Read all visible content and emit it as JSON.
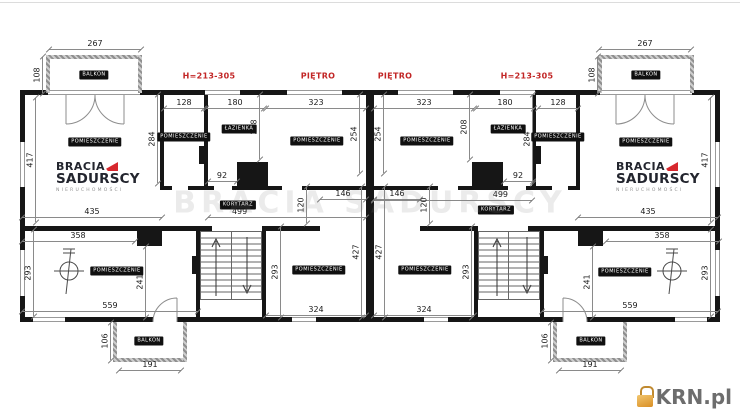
{
  "watermark": {
    "text": "BRACIA SADURSCY"
  },
  "logo": {
    "line1": "BRACIA",
    "line2": "SADURSCY",
    "line3": "NIERUCHOMOŚCI"
  },
  "krn": {
    "label": "KRN.pl"
  },
  "red_labels": [
    {
      "text": "H=213-305",
      "x": 209,
      "y": 76
    },
    {
      "text": "PIĘTRO",
      "x": 318,
      "y": 76
    },
    {
      "text": "PIĘTRO",
      "x": 395,
      "y": 76
    },
    {
      "text": "H=213-305",
      "x": 527,
      "y": 76
    }
  ],
  "room_badges": [
    {
      "text": "POMIESZCZENIE",
      "x": 95,
      "y": 142
    },
    {
      "text": "POMIESZCZENIE",
      "x": 184,
      "y": 137
    },
    {
      "text": "ŁAZIENKA",
      "x": 239,
      "y": 129
    },
    {
      "text": "POMIESZCZENIE",
      "x": 317,
      "y": 141
    },
    {
      "text": "KORYTARZ",
      "x": 238,
      "y": 205
    },
    {
      "text": "POMIESZCZENIE",
      "x": 117,
      "y": 271
    },
    {
      "text": "POMIESZCZENIE",
      "x": 319,
      "y": 270
    },
    {
      "text": "BALKON",
      "x": 94,
      "y": 75
    },
    {
      "text": "BALKON",
      "x": 149,
      "y": 341
    },
    {
      "text": "POMIESZCZENIE",
      "x": 646,
      "y": 142
    },
    {
      "text": "POMIESZCZENIE",
      "x": 558,
      "y": 137
    },
    {
      "text": "ŁAZIENKA",
      "x": 508,
      "y": 129
    },
    {
      "text": "POMIESZCZENIE",
      "x": 427,
      "y": 141
    },
    {
      "text": "KORYTARZ",
      "x": 496,
      "y": 210
    },
    {
      "text": "POMIESZCZENIE",
      "x": 625,
      "y": 272
    },
    {
      "text": "POMIESZCZENIE",
      "x": 425,
      "y": 270
    },
    {
      "text": "BALKON",
      "x": 646,
      "y": 75
    },
    {
      "text": "BALKON",
      "x": 591,
      "y": 341
    }
  ],
  "dims": [
    {
      "t": "267",
      "x": 95,
      "y": 49,
      "len": 92
    },
    {
      "t": "108",
      "x": 42,
      "y": 75,
      "len": 36,
      "v": true
    },
    {
      "t": "128",
      "x": 184,
      "y": 108,
      "len": 40
    },
    {
      "t": "180",
      "x": 235,
      "y": 108,
      "len": 58
    },
    {
      "t": "323",
      "x": 316,
      "y": 108,
      "len": 100
    },
    {
      "t": "284",
      "x": 157,
      "y": 139,
      "len": 88,
      "v": true
    },
    {
      "t": "208",
      "x": 259,
      "y": 127,
      "len": 64,
      "v": true
    },
    {
      "t": "254",
      "x": 359,
      "y": 134,
      "len": 78,
      "v": true
    },
    {
      "t": "92",
      "x": 222,
      "y": 181,
      "len": 29
    },
    {
      "t": "417",
      "x": 35,
      "y": 160,
      "len": 124,
      "v": true
    },
    {
      "t": "435",
      "x": 92,
      "y": 217,
      "len": 140
    },
    {
      "t": "499",
      "x": 287,
      "y": 217,
      "len": 158,
      "lx": 20
    },
    {
      "t": "146",
      "x": 343,
      "y": 199,
      "len": 46
    },
    {
      "t": "120",
      "x": 306,
      "y": 205,
      "len": 36,
      "v": true
    },
    {
      "t": "293",
      "x": 280,
      "y": 272,
      "len": 90,
      "v": true
    },
    {
      "t": "324",
      "x": 316,
      "y": 315,
      "len": 100
    },
    {
      "t": "427",
      "x": 361,
      "y": 252,
      "len": 130,
      "v": true
    },
    {
      "t": "358",
      "x": 78,
      "y": 241,
      "len": 113
    },
    {
      "t": "293",
      "x": 33,
      "y": 273,
      "len": 86,
      "v": true
    },
    {
      "t": "241",
      "x": 145,
      "y": 282,
      "len": 70,
      "v": true
    },
    {
      "t": "559",
      "x": 110,
      "y": 311,
      "len": 176
    },
    {
      "t": "106",
      "x": 110,
      "y": 341,
      "len": 37,
      "v": true
    },
    {
      "t": "191",
      "x": 150,
      "y": 370,
      "len": 62
    },
    {
      "t": "267",
      "x": 645,
      "y": 49,
      "len": 92
    },
    {
      "t": "108",
      "x": 597,
      "y": 75,
      "len": 36,
      "v": true
    },
    {
      "t": "128",
      "x": 558,
      "y": 108,
      "len": 40
    },
    {
      "t": "180",
      "x": 505,
      "y": 108,
      "len": 58
    },
    {
      "t": "323",
      "x": 424,
      "y": 108,
      "len": 100
    },
    {
      "t": "284",
      "x": 532,
      "y": 139,
      "len": 88,
      "v": true
    },
    {
      "t": "208",
      "x": 469,
      "y": 127,
      "len": 64,
      "v": true
    },
    {
      "t": "254",
      "x": 383,
      "y": 134,
      "len": 78,
      "v": true
    },
    {
      "t": "92",
      "x": 518,
      "y": 181,
      "len": 29
    },
    {
      "t": "417",
      "x": 710,
      "y": 160,
      "len": 124,
      "v": true
    },
    {
      "t": "435",
      "x": 648,
      "y": 217,
      "len": 140
    },
    {
      "t": "499",
      "x": 453,
      "y": 200,
      "len": 158,
      "lx": 80
    },
    {
      "t": "146",
      "x": 397,
      "y": 199,
      "len": 46
    },
    {
      "t": "120",
      "x": 429,
      "y": 205,
      "len": 36,
      "v": true
    },
    {
      "t": "293",
      "x": 471,
      "y": 272,
      "len": 90,
      "v": true
    },
    {
      "t": "324",
      "x": 424,
      "y": 315,
      "len": 100
    },
    {
      "t": "427",
      "x": 384,
      "y": 252,
      "len": 130,
      "v": true
    },
    {
      "t": "358",
      "x": 662,
      "y": 241,
      "len": 113
    },
    {
      "t": "293",
      "x": 710,
      "y": 273,
      "len": 86,
      "v": true
    },
    {
      "t": "241",
      "x": 592,
      "y": 282,
      "len": 70,
      "v": true
    },
    {
      "t": "559",
      "x": 630,
      "y": 311,
      "len": 176
    },
    {
      "t": "106",
      "x": 550,
      "y": 341,
      "len": 37,
      "v": true
    },
    {
      "t": "191",
      "x": 590,
      "y": 370,
      "len": 62
    }
  ],
  "colors": {
    "wall": "#161616",
    "dimension_line": "#8a8a8a",
    "dimension_text": "#1a1a1a",
    "red_label": "#c22626",
    "badge_bg": "#101010",
    "badge_text": "#ffffff",
    "logo_text": "#23252e",
    "logo_mark": "#d7282e",
    "balcony_wall": "#a0a0a0",
    "krn_text": "#6d6d6d",
    "krn_icon": "#e2a23b"
  }
}
